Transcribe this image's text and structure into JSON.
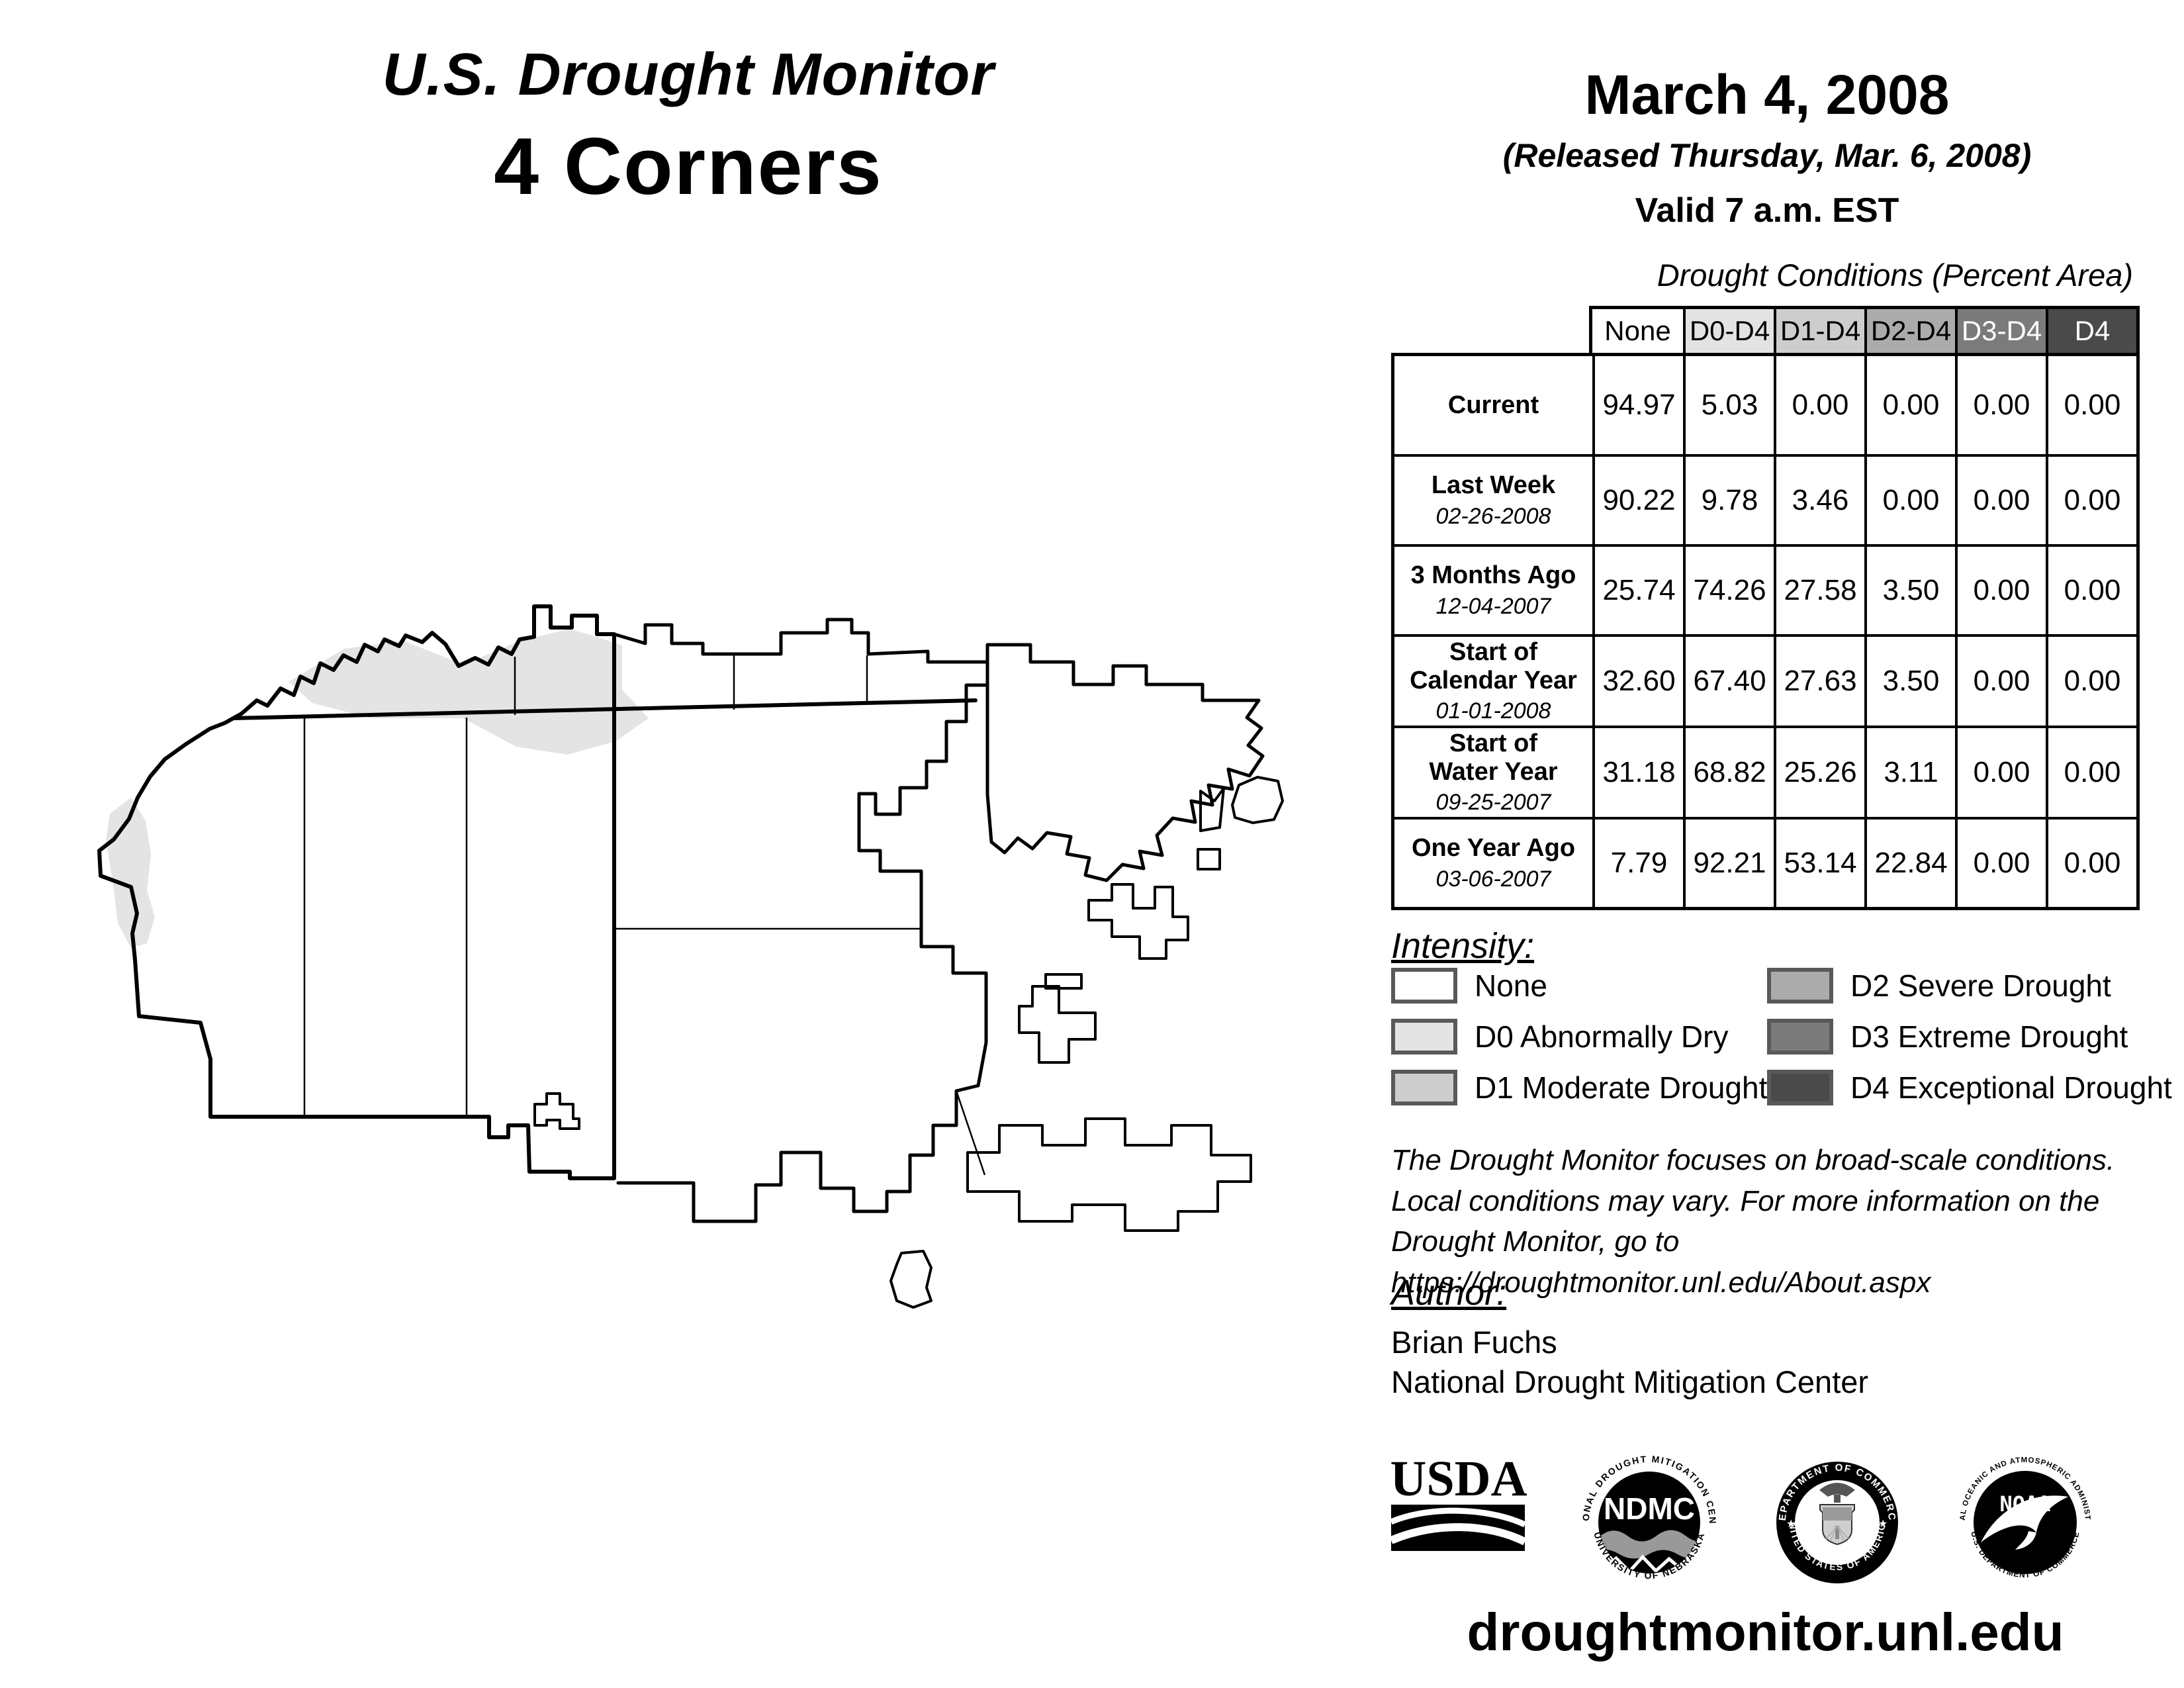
{
  "title": {
    "line1": "U.S. Drought Monitor",
    "line2": "4 Corners"
  },
  "date_block": {
    "date": "March 4, 2008",
    "released": "(Released Thursday, Mar. 6, 2008)",
    "valid": "Valid 7 a.m. EST"
  },
  "table": {
    "caption": "Drought Conditions (Percent Area)",
    "columns": [
      {
        "label": "None",
        "bg": "#ffffff",
        "fg": "#000000"
      },
      {
        "label": "D0-D4",
        "bg": "#e3e3e3",
        "fg": "#000000"
      },
      {
        "label": "D1-D4",
        "bg": "#cdcdcd",
        "fg": "#000000"
      },
      {
        "label": "D2-D4",
        "bg": "#ababab",
        "fg": "#000000"
      },
      {
        "label": "D3-D4",
        "bg": "#7b7b7b",
        "fg": "#ffffff"
      },
      {
        "label": "D4",
        "bg": "#4a4a4a",
        "fg": "#ffffff"
      }
    ],
    "rows": [
      {
        "label": "Current",
        "label2": "",
        "date": "",
        "values": [
          "94.97",
          "5.03",
          "0.00",
          "0.00",
          "0.00",
          "0.00"
        ]
      },
      {
        "label": "Last Week",
        "label2": "",
        "date": "02-26-2008",
        "values": [
          "90.22",
          "9.78",
          "3.46",
          "0.00",
          "0.00",
          "0.00"
        ]
      },
      {
        "label": "3 Months Ago",
        "label2": "",
        "date": "12-04-2007",
        "values": [
          "25.74",
          "74.26",
          "27.58",
          "3.50",
          "0.00",
          "0.00"
        ]
      },
      {
        "label": "Start of",
        "label2": "Calendar Year",
        "date": "01-01-2008",
        "values": [
          "32.60",
          "67.40",
          "27.63",
          "3.50",
          "0.00",
          "0.00"
        ]
      },
      {
        "label": "Start of",
        "label2": "Water Year",
        "date": "09-25-2007",
        "values": [
          "31.18",
          "68.82",
          "25.26",
          "3.11",
          "0.00",
          "0.00"
        ]
      },
      {
        "label": "One Year Ago",
        "label2": "",
        "date": "03-06-2007",
        "values": [
          "7.79",
          "92.21",
          "53.14",
          "22.84",
          "0.00",
          "0.00"
        ]
      }
    ]
  },
  "legend": {
    "heading": "Intensity:",
    "items": [
      {
        "label": "None",
        "color": "#ffffff"
      },
      {
        "label": "D0 Abnormally Dry",
        "color": "#e4e4e4"
      },
      {
        "label": "D1 Moderate Drought",
        "color": "#cdcdcd"
      },
      {
        "label": "D2 Severe Drought",
        "color": "#ababab"
      },
      {
        "label": "D3 Extreme Drought",
        "color": "#7b7b7b"
      },
      {
        "label": "D4 Exceptional Drought",
        "color": "#4a4a4a"
      }
    ]
  },
  "disclaimer": {
    "line1": "The Drought Monitor focuses on broad-scale conditions.",
    "line2": "Local conditions may vary. For more information on the",
    "line3": "Drought Monitor, go to https://droughtmonitor.unl.edu/About.aspx"
  },
  "author": {
    "heading": "Author:",
    "name": "Brian Fuchs",
    "org": "National Drought Mitigation Center"
  },
  "logos": {
    "usda": {
      "text": "USDA"
    },
    "ndmc": {
      "text": "NDMC",
      "ring_top": "NATIONAL DROUGHT MITIGATION CENTER",
      "ring_bottom": "UNIVERSITY OF NEBRASKA"
    },
    "doc": {
      "ring_top": "DEPARTMENT OF COMMERCE",
      "ring_bottom": "UNITED STATES OF AMERICA"
    },
    "noaa": {
      "text": "NOAA",
      "ring_top": "NATIONAL OCEANIC AND ATMOSPHERIC ADMINISTRATION",
      "ring_bottom": "U.S. DEPARTMENT OF COMMERCE"
    }
  },
  "footer": {
    "url": "droughtmonitor.unl.edu"
  },
  "map": {
    "region_fill": "#ffffff",
    "outline": "#000000",
    "d0_fill": "#e4e4e4"
  },
  "chart_data": {
    "type": "table",
    "title": "Drought Conditions (Percent Area)",
    "columns": [
      "None",
      "D0-D4",
      "D1-D4",
      "D2-D4",
      "D3-D4",
      "D4"
    ],
    "rows": [
      {
        "label": "Current",
        "values": [
          94.97,
          5.03,
          0.0,
          0.0,
          0.0,
          0.0
        ]
      },
      {
        "label": "Last Week (02-26-2008)",
        "values": [
          90.22,
          9.78,
          3.46,
          0.0,
          0.0,
          0.0
        ]
      },
      {
        "label": "3 Months Ago (12-04-2007)",
        "values": [
          25.74,
          74.26,
          27.58,
          3.5,
          0.0,
          0.0
        ]
      },
      {
        "label": "Start of Calendar Year (01-01-2008)",
        "values": [
          32.6,
          67.4,
          27.63,
          3.5,
          0.0,
          0.0
        ]
      },
      {
        "label": "Start of Water Year (09-25-2007)",
        "values": [
          31.18,
          68.82,
          25.26,
          3.11,
          0.0,
          0.0
        ]
      },
      {
        "label": "One Year Ago (03-06-2007)",
        "values": [
          7.79,
          92.21,
          53.14,
          22.84,
          0.0,
          0.0
        ]
      }
    ]
  }
}
